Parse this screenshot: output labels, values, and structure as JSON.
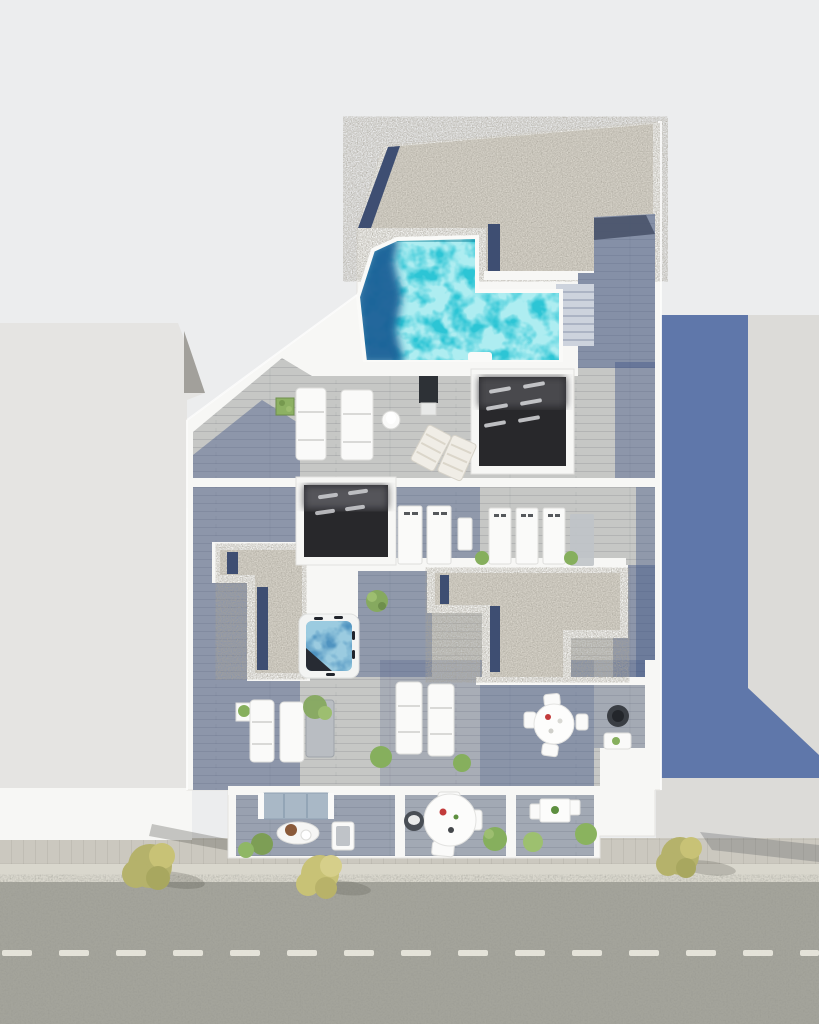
{
  "scene": {
    "kind": "architectural-3d-render",
    "view": "top-down aerial",
    "subject": "rooftop terrace floor plan with swimming pool, jacuzzi, sun decks and street below"
  },
  "palette": {
    "bg": "#ECEDEE",
    "wall": "#F7F7F5",
    "gravel": "#D8D4CA",
    "gravel-edge": "#3E4E72",
    "pool": "#2CC5D5",
    "pool-deep": "#1B6097",
    "deck": "#C6C7C5",
    "shadow": "#3E5485",
    "interior": "#28282B",
    "jacuzzi": "#4F93C0",
    "asphalt": "#A4A49B",
    "sidewalk": "#CBC8BF",
    "curb": "#D9D7CD",
    "marking": "#ECEAE0",
    "neighbor-left": "#E5E4E2",
    "neighbor-left-face": "#A2A09B",
    "neighbor-right": "#DCDBD8",
    "shadow-blue": "#5B74A8",
    "tree": "#B5B26B",
    "tree-yellow": "#C8C276",
    "bush": "#86AF5D",
    "furniture-white": "#FAFAF9",
    "furniture-gray": "#BFC3C8",
    "sofa": "#A9B8C6",
    "accent-red": "#C23B3B"
  },
  "inventory": [
    "gravel-roof",
    "roof-stair-corridor",
    "swimming-pool",
    "pool-deep-end",
    "skylight-opening-north",
    "skylight-opening-west",
    "jacuzzi",
    "sun-loungers-north",
    "beach-chairs",
    "outdoor-shower-panel",
    "equipment-units",
    "gravel-planter-strip-west",
    "gravel-section-center",
    "daybed-group-southwest",
    "sun-loungers-south",
    "dining-set",
    "fire-bowl",
    "balcony-lounge",
    "balcony-dining-round",
    "balcony-dining-small",
    "street",
    "sidewalk",
    "street-trees",
    "neighbor-building-left",
    "neighbor-building-right",
    "building-shadow"
  ]
}
